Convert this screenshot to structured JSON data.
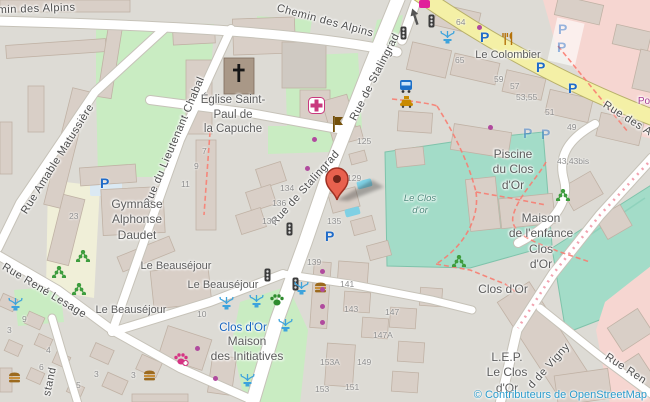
{
  "map_canvas": {
    "attribution": "© Contributeurs de OpenStreetMap",
    "marker": {
      "x": 337,
      "y": 200,
      "color": "#e8614e"
    },
    "colors": {
      "background": "#dddbd5",
      "building": "#d9cfc7",
      "road_yellow": "#f4f0a6",
      "park_green": "#c9ecc2",
      "pitch_teal": "#a3dcc8",
      "retail_pink": "#f6d6d1",
      "school_yellow": "#f0efd8",
      "path_pink": "#f87e72",
      "parking_blue": "#1f6bc9",
      "transit_blue": "#1865c0",
      "attribution_blue": "#2b9ccc"
    }
  },
  "street_labels": [
    {
      "text": "Chemin des Alpins",
      "x": -24,
      "y": 11,
      "r": -2
    },
    {
      "text": "Chemin des Alpins",
      "x": 277,
      "y": 8,
      "r": 15
    },
    {
      "text": "Rue de Stalingrad",
      "x": 353,
      "y": 120,
      "r": -63
    },
    {
      "text": "Rue de Stalingrad",
      "x": 273,
      "y": 224,
      "r": -48
    },
    {
      "text": "Rue Amable Matussière",
      "x": 24,
      "y": 213,
      "r": -58
    },
    {
      "text": "Rue du Lieutenant Chabal",
      "x": 147,
      "y": 206,
      "r": -67
    },
    {
      "text": "Rue René Lesage",
      "x": 3,
      "y": 266,
      "r": 31
    },
    {
      "text": "stand",
      "x": 47,
      "y": 396,
      "r": -78
    },
    {
      "text": "d de Vigny",
      "x": 530,
      "y": 387,
      "r": -48
    },
    {
      "text": "Rue Ren",
      "x": 606,
      "y": 356,
      "r": 33
    },
    {
      "text": "Rue des A",
      "x": 604,
      "y": 104,
      "r": 32
    }
  ],
  "place_labels": [
    {
      "lines": [
        "Église Saint-",
        "Paul de",
        "la Capuche"
      ],
      "cx": 233,
      "y": 93,
      "size": 11.5
    },
    {
      "lines": [
        "Gymnase",
        "Alphonse",
        "Daudet"
      ],
      "cx": 137,
      "y": 197,
      "size": 12
    },
    {
      "lines": [
        "Le Colombier"
      ],
      "cx": 508,
      "y": 48,
      "size": 11
    },
    {
      "lines": [
        "Piscine",
        "du Clos",
        "d'Or"
      ],
      "cx": 513,
      "y": 147,
      "size": 12
    },
    {
      "lines": [
        "Le Clos",
        "d'or"
      ],
      "cx": 420,
      "y": 193,
      "size": 9.5,
      "color": "#4d8a7c",
      "italic": true
    },
    {
      "lines": [
        "Maison",
        "de l'enfance",
        "Clos",
        "d'Or"
      ],
      "cx": 541,
      "y": 211,
      "size": 12
    },
    {
      "lines": [
        "Clos d'Or"
      ],
      "cx": 503,
      "y": 282,
      "size": 12
    },
    {
      "lines": [
        "L.E.P.",
        "Le Clos",
        "d'Or"
      ],
      "cx": 507,
      "y": 350,
      "size": 12
    },
    {
      "lines": [
        "Le Beauséjour"
      ],
      "cx": 176,
      "y": 259,
      "size": 11
    },
    {
      "lines": [
        "Le Beauséjour"
      ],
      "cx": 223,
      "y": 278,
      "size": 11
    },
    {
      "lines": [
        "Le Beauséjour"
      ],
      "cx": 131,
      "y": 303,
      "size": 11
    },
    {
      "lines": [
        "Clos d'Or"
      ],
      "cx": 243,
      "y": 321,
      "size": 11.5,
      "color": "#1865c0"
    },
    {
      "lines": [
        "Maison",
        "des Initiatives"
      ],
      "cx": 247,
      "y": 334,
      "size": 12
    },
    {
      "lines": [
        "Po"
      ],
      "cx": 644,
      "y": 96,
      "size": 10,
      "color": "#a63f94"
    }
  ],
  "house_numbers": [
    {
      "t": "64",
      "x": 456,
      "y": 17
    },
    {
      "t": "65",
      "x": 455,
      "y": 55
    },
    {
      "t": "59",
      "x": 494,
      "y": 74
    },
    {
      "t": "57",
      "x": 510,
      "y": 81
    },
    {
      "t": "53,55",
      "x": 516,
      "y": 92
    },
    {
      "t": "51",
      "x": 545,
      "y": 107
    },
    {
      "t": "49",
      "x": 567,
      "y": 122
    },
    {
      "t": "43,43bis",
      "x": 557,
      "y": 156
    },
    {
      "t": "125",
      "x": 357,
      "y": 136
    },
    {
      "t": "129",
      "x": 347,
      "y": 173
    },
    {
      "t": "134",
      "x": 280,
      "y": 183
    },
    {
      "t": "136",
      "x": 272,
      "y": 198
    },
    {
      "t": "138",
      "x": 262,
      "y": 216
    },
    {
      "t": "135",
      "x": 327,
      "y": 216
    },
    {
      "t": "139",
      "x": 307,
      "y": 257
    },
    {
      "t": "141",
      "x": 340,
      "y": 279
    },
    {
      "t": "143",
      "x": 344,
      "y": 304
    },
    {
      "t": "147",
      "x": 385,
      "y": 307
    },
    {
      "t": "147A",
      "x": 373,
      "y": 330
    },
    {
      "t": "149",
      "x": 357,
      "y": 357
    },
    {
      "t": "153A",
      "x": 320,
      "y": 357
    },
    {
      "t": "151",
      "x": 345,
      "y": 382
    },
    {
      "t": "153",
      "x": 315,
      "y": 384
    },
    {
      "t": "23",
      "x": 69,
      "y": 211
    },
    {
      "t": "7",
      "x": 202,
      "y": 146
    },
    {
      "t": "9",
      "x": 194,
      "y": 161
    },
    {
      "t": "11",
      "x": 181,
      "y": 179
    },
    {
      "t": "10",
      "x": 197,
      "y": 309
    },
    {
      "t": "9",
      "x": 22,
      "y": 314
    },
    {
      "t": "3",
      "x": 7,
      "y": 325
    },
    {
      "t": "4",
      "x": 46,
      "y": 345
    },
    {
      "t": "6",
      "x": 39,
      "y": 362
    },
    {
      "t": "5",
      "x": 76,
      "y": 380
    },
    {
      "t": "3",
      "x": 94,
      "y": 369
    },
    {
      "t": "3",
      "x": 131,
      "y": 370
    }
  ],
  "icons": [
    {
      "type": "parking",
      "x": 100,
      "y": 176
    },
    {
      "type": "parking",
      "x": 325,
      "y": 229
    },
    {
      "type": "parking",
      "x": 480,
      "y": 30
    },
    {
      "type": "parking",
      "x": 536,
      "y": 60
    },
    {
      "type": "parking",
      "x": 568,
      "y": 81
    },
    {
      "type": "parking_faded",
      "x": 558,
      "y": 22
    },
    {
      "type": "parking_faded",
      "x": 557,
      "y": 40
    },
    {
      "type": "parking_faded",
      "x": 523,
      "y": 126
    },
    {
      "type": "parking_faded",
      "x": 541,
      "y": 127
    },
    {
      "type": "traffic_light",
      "x": 286,
      "y": 222
    },
    {
      "type": "traffic_light",
      "x": 264,
      "y": 268
    },
    {
      "type": "traffic_light",
      "x": 292,
      "y": 277
    },
    {
      "type": "traffic_light",
      "x": 400,
      "y": 26
    },
    {
      "type": "traffic_light",
      "x": 428,
      "y": 14
    },
    {
      "type": "bus",
      "x": 399,
      "y": 80
    },
    {
      "type": "taxi",
      "x": 399,
      "y": 96
    },
    {
      "type": "pharmacy",
      "x": 308,
      "y": 97
    },
    {
      "type": "museum",
      "x": 332,
      "y": 116
    },
    {
      "type": "church",
      "x": 231,
      "y": 64
    },
    {
      "type": "restaurant",
      "x": 501,
      "y": 32
    },
    {
      "type": "burger",
      "x": 314,
      "y": 282
    },
    {
      "type": "burger",
      "x": 143,
      "y": 370
    },
    {
      "type": "burger",
      "x": 8,
      "y": 372
    },
    {
      "type": "fountain",
      "x": 440,
      "y": 30
    },
    {
      "type": "fountain",
      "x": 294,
      "y": 281
    },
    {
      "type": "fountain",
      "x": 249,
      "y": 294
    },
    {
      "type": "fountain",
      "x": 219,
      "y": 296
    },
    {
      "type": "fountain",
      "x": 278,
      "y": 318
    },
    {
      "type": "fountain",
      "x": 240,
      "y": 373
    },
    {
      "type": "fountain",
      "x": 8,
      "y": 297
    },
    {
      "type": "paw",
      "x": 270,
      "y": 294
    },
    {
      "type": "vet",
      "x": 174,
      "y": 353
    },
    {
      "type": "playground",
      "x": 52,
      "y": 266
    },
    {
      "type": "playground",
      "x": 72,
      "y": 283
    },
    {
      "type": "playground",
      "x": 76,
      "y": 250
    },
    {
      "type": "picnic",
      "x": 556,
      "y": 189
    },
    {
      "type": "picnic",
      "x": 452,
      "y": 255
    },
    {
      "type": "dot",
      "x": 477,
      "y": 25
    },
    {
      "type": "dot",
      "x": 312,
      "y": 137
    },
    {
      "type": "dot",
      "x": 305,
      "y": 166
    },
    {
      "type": "dot",
      "x": 195,
      "y": 346
    },
    {
      "type": "dot",
      "x": 213,
      "y": 376
    },
    {
      "type": "dot",
      "x": 320,
      "y": 269
    },
    {
      "type": "dot",
      "x": 320,
      "y": 287
    },
    {
      "type": "dot",
      "x": 320,
      "y": 304
    },
    {
      "type": "dot",
      "x": 320,
      "y": 320
    },
    {
      "type": "dot",
      "x": 488,
      "y": 125
    },
    {
      "type": "shop",
      "x": 419,
      "y": 0
    },
    {
      "type": "arrow",
      "x": 410,
      "y": 8,
      "r": -18
    }
  ]
}
